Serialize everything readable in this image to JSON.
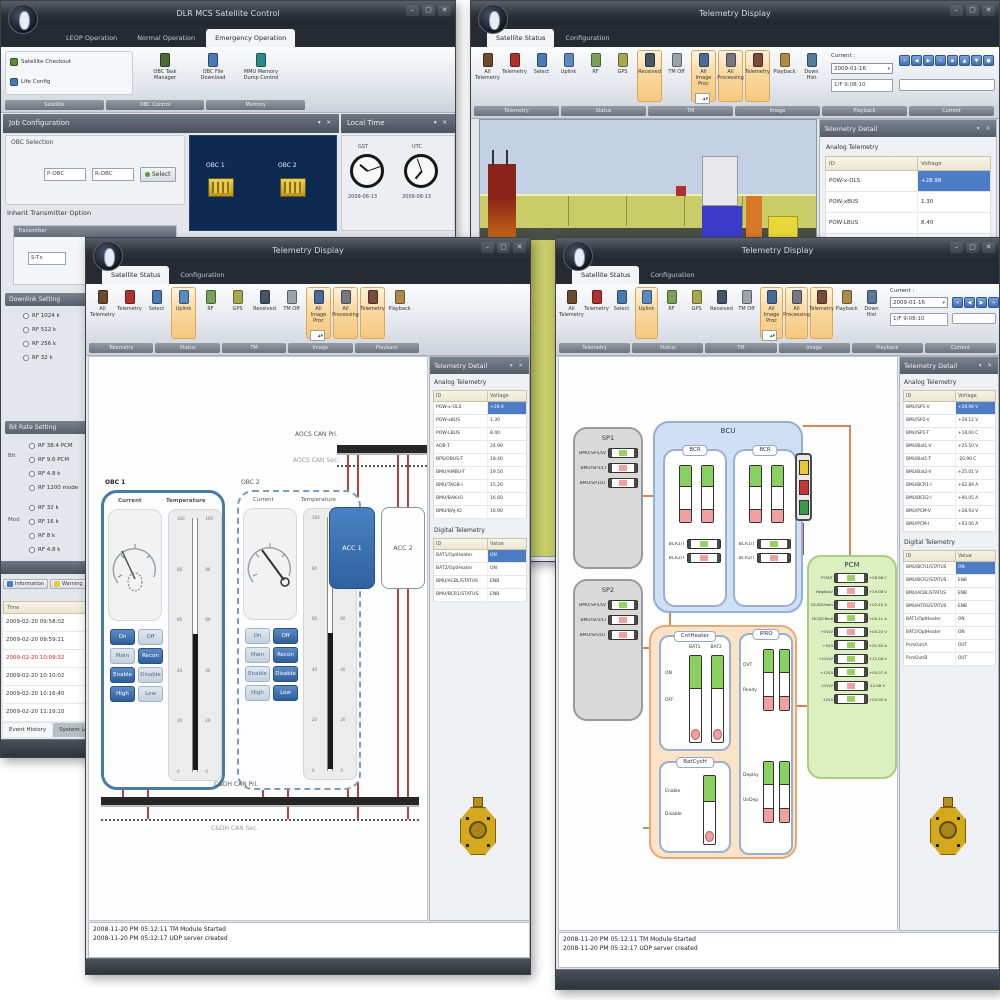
{
  "colors": {
    "selection_blue": "#4d7cc7",
    "ribbon_highlight": "#f5c87e",
    "accent_blue": "#3a72b5",
    "wire_red": "#b84040",
    "wire_orange": "#d88858",
    "navy_panel": "#0e2a52",
    "gold": "#d4a91e",
    "bus_black": "#262626"
  },
  "chrome": {
    "min": "–",
    "max": "▢",
    "close": "✕",
    "panel_icons": "▾ ✕"
  },
  "windowA": {
    "title": "DLR MCS Satellite Control",
    "tabs": [
      {
        "label": "LEOP Operation"
      },
      {
        "label": "Normal Operation"
      },
      {
        "label": "Emergency Operation",
        "active": true
      }
    ],
    "ribbon": {
      "side_buttons": [
        {
          "label": "Satellite Checkout",
          "c": "#5a8a3a"
        },
        {
          "label": "Life Config",
          "c": "#4a7ab5"
        }
      ],
      "big_buttons": [
        {
          "label": "OBC Task Manager",
          "c": "#4a6a3a"
        },
        {
          "label": "OBC File Download",
          "c": "#4a7ab5"
        },
        {
          "label": "MMU Memory Dump Control",
          "c": "#2a8a8a"
        }
      ],
      "groups": [
        "Satellite",
        "OBC Control",
        "Memory"
      ]
    },
    "job_config_header": "Job Configuration",
    "local_time_header": "Local Time",
    "obc_selection": {
      "legend": "OBC Selection",
      "fields": [
        "P-OBC",
        "R-OBC"
      ],
      "select_label": "Select"
    },
    "navy": {
      "items": [
        {
          "label": "OBC 1"
        },
        {
          "label": "OBC 2"
        }
      ]
    },
    "clocks": [
      {
        "caption": "GST",
        "date": "2009-08-13"
      },
      {
        "caption": "UTC",
        "date": "2009-08-13"
      }
    ],
    "transmitter": {
      "legend": "Inherit Transmitter Option",
      "sub_header": "Transmitter",
      "field": "S-Tx"
    },
    "downlink_group": {
      "header": "Downlink Setting",
      "items": [
        "RF 1024 k",
        "RF 512 k",
        "RF 256 k",
        "RF 32 k"
      ]
    },
    "rate_group": {
      "header": "Bit Rate Setting",
      "side1": "Bit",
      "items1": [
        "RF 38.4 PCM",
        "RF 9.6 PCM",
        "RF 4.8 k",
        "RF 1200 mode"
      ],
      "side2": "Mod",
      "items2": [
        "RF 32 k",
        "RF 16 k",
        "RF 8 k",
        "RF 4.8 k"
      ]
    },
    "events": {
      "filters": [
        {
          "label": "Information",
          "c": "#4d7cc7"
        },
        {
          "label": "Warning",
          "c": "#e8c84a"
        },
        {
          "label": "Error",
          "c": "#c0392b"
        }
      ],
      "col": "Time",
      "rows": [
        {
          "t": "2009-02-20 09:58:02"
        },
        {
          "t": "2009-02-20 09:59:11"
        },
        {
          "t": "2009-02-20 10:09:32",
          "err": true
        },
        {
          "t": "2009-02-20 10:10:02"
        },
        {
          "t": "2009-02-20 10:16:40"
        },
        {
          "t": "2009-02-20 11:19:10"
        }
      ],
      "tabs": [
        {
          "label": "Event History",
          "active": true
        },
        {
          "label": "System Log"
        }
      ]
    }
  },
  "windowB": {
    "title": "Telemetry Display",
    "tabs": [
      {
        "label": "Satellite Status",
        "active": true
      },
      {
        "label": "Configuration"
      }
    ],
    "ribbon": {
      "buttons": [
        {
          "label": "All Telemetry",
          "c": "#6b4a2f"
        },
        {
          "label": "Telemetry",
          "c": "#b03030"
        },
        {
          "label": "Select",
          "c": "#4a7ab5"
        },
        {
          "label": "Uplink",
          "c": "#5a8ac0"
        },
        {
          "label": "RF",
          "c": "#7aa05a"
        },
        {
          "label": "GPS",
          "c": "#a8a84a"
        },
        {
          "label": "Received",
          "c": "#445566",
          "hl": true
        },
        {
          "label": "TM Off",
          "c": "#9aa4ae"
        },
        {
          "label": "All Image Proc",
          "c": "#4a6a9a",
          "hl": true
        },
        {
          "label": "All Processing",
          "c": "#777788",
          "hl": true
        },
        {
          "label": "Telemetry",
          "c": "#7a4a3a",
          "hl": true
        },
        {
          "label": "Playback",
          "c": "#b08a4a"
        },
        {
          "label": "Down Hist",
          "c": "#5a7a9a"
        }
      ],
      "groups": [
        "Telemetry",
        "Status",
        "TM",
        "Image",
        "Playback",
        "Current"
      ],
      "spinner": "",
      "current": {
        "label": "Current :",
        "value": "2009-01-16",
        "time": "1/F  9:08:10"
      },
      "nav": [
        "«",
        "◀",
        "▶",
        "»",
        "▪",
        "▲",
        "▼",
        "●"
      ]
    },
    "panel": {
      "header": "Telemetry Detail",
      "analog_title": "Analog Telemetry",
      "cols": [
        "ID",
        "Voltage"
      ],
      "rows": [
        {
          "id": "POW-x-OLS",
          "v": "+28.98",
          "sel": true
        },
        {
          "id": "POW-xBUS",
          "v": "1.30"
        },
        {
          "id": "POW-LBUS",
          "v": "8.40"
        },
        {
          "id": "AOB-T",
          "v": "24.90"
        }
      ]
    }
  },
  "windowC": {
    "title": "Telemetry Display",
    "tabs": [
      {
        "label": "Satellite Status",
        "active": true
      },
      {
        "label": "Configuration"
      }
    ],
    "ribbon": {
      "buttons": [
        {
          "label": "All Telemetry",
          "c": "#6b4a2f"
        },
        {
          "label": "Telemetry",
          "c": "#b03030"
        },
        {
          "label": "Select",
          "c": "#4a7ab5"
        },
        {
          "label": "Uplink",
          "c": "#5a8ac0",
          "hl": true
        },
        {
          "label": "RF",
          "c": "#7aa05a"
        },
        {
          "label": "GPS",
          "c": "#a8a84a"
        },
        {
          "label": "Received",
          "c": "#445566"
        },
        {
          "label": "TM Off",
          "c": "#9aa4ae"
        },
        {
          "label": "All Image Proc",
          "c": "#4a6a9a",
          "hl": true
        },
        {
          "label": "All Processing",
          "c": "#777788",
          "hl": true
        },
        {
          "label": "Telemetry",
          "c": "#7a4a3a",
          "hl": true
        },
        {
          "label": "Playback",
          "c": "#b08a4a"
        }
      ],
      "groups": [
        "Telemetry",
        "Status",
        "TM",
        "Image",
        "Playback"
      ],
      "spinner": ""
    },
    "diagram": {
      "aocs_pri": "AOCS CAN Pri.",
      "aocs_sec": "AOCS CAN Sec.",
      "cdh_pri": "C&DH CAN Pri.",
      "cdh_sec": "C&DH CAN Sec.",
      "acc1": "ACC 1",
      "acc2": "ACC 2",
      "obc1": {
        "title": "OBC 1",
        "gauge_label": "Current",
        "thermo_label": "Temperature",
        "scale": [
          "100",
          "80",
          "60",
          "40",
          "20",
          "0"
        ],
        "buttons": [
          {
            "label": "On",
            "on": true
          },
          {
            "label": "Off"
          },
          {
            "label": "Main"
          },
          {
            "label": "Recon",
            "on": true
          },
          {
            "label": "Enable",
            "on": true
          },
          {
            "label": "Disable"
          },
          {
            "label": "High",
            "on": true
          },
          {
            "label": "Low"
          }
        ]
      },
      "obc2": {
        "title": "OBC 2",
        "gauge_label": "Current",
        "thermo_label": "Temperature",
        "scale": [
          "100",
          "80",
          "60",
          "40",
          "20",
          "0"
        ],
        "buttons": [
          {
            "label": "On"
          },
          {
            "label": "Off",
            "on": true
          },
          {
            "label": "Main"
          },
          {
            "label": "Recon",
            "on": true
          },
          {
            "label": "Enable"
          },
          {
            "label": "Disable",
            "on": true
          },
          {
            "label": "High"
          },
          {
            "label": "Low",
            "on": true
          }
        ]
      }
    },
    "panel": {
      "header": "Telemetry Detail",
      "analog_title": "Analog Telemetry",
      "analog_cols": [
        "ID",
        "Voltage"
      ],
      "analog_rows": [
        {
          "id": "POW-x-OLS",
          "v": "+28.9",
          "sel": true
        },
        {
          "id": "POW-xBUS",
          "v": "1.30"
        },
        {
          "id": "POW-LBUS",
          "v": "8.40"
        },
        {
          "id": "AOB-T",
          "v": "24.90"
        },
        {
          "id": "BPS/OBUS-T",
          "v": "18.40"
        },
        {
          "id": "BMU/AMBU-T",
          "v": "19.50"
        },
        {
          "id": "BMU/TAGB-I",
          "v": "15.20"
        },
        {
          "id": "BMU/BAK-IO",
          "v": "16.60"
        },
        {
          "id": "BMU/BAJ-IO",
          "v": "16.90"
        }
      ],
      "digital_title": "Digital Telemetry",
      "digital_cols": [
        "ID",
        "Value"
      ],
      "digital_rows": [
        {
          "id": "BAT1/OptHeater",
          "v": "ON",
          "sel": true
        },
        {
          "id": "BAT2/OptHeater",
          "v": "ON"
        },
        {
          "id": "BMU/ACBL/STATUS",
          "v": "ENB"
        },
        {
          "id": "BMU/BCR1/STATUS",
          "v": "ENB"
        }
      ]
    },
    "log": {
      "lines": [
        "2008-11-20 PM 05:12:11   TM Module Started",
        "2008-11-20 PM 05:12:17   UDP server created"
      ]
    }
  },
  "windowD": {
    "title": "Telemetry Display",
    "tabs": [
      {
        "label": "Satellite Status",
        "active": true
      },
      {
        "label": "Configuration"
      }
    ],
    "ribbon": {
      "buttons": [
        {
          "label": "All Telemetry",
          "c": "#6b4a2f"
        },
        {
          "label": "Telemetry",
          "c": "#b03030"
        },
        {
          "label": "Select",
          "c": "#4a7ab5"
        },
        {
          "label": "Uplink",
          "c": "#5a8ac0",
          "hl": true
        },
        {
          "label": "RF",
          "c": "#7aa05a"
        },
        {
          "label": "GPS",
          "c": "#a8a84a"
        },
        {
          "label": "Received",
          "c": "#445566"
        },
        {
          "label": "TM Off",
          "c": "#9aa4ae"
        },
        {
          "label": "All Image Proc",
          "c": "#4a6a9a",
          "hl": true
        },
        {
          "label": "All Processing",
          "c": "#777788",
          "hl": true
        },
        {
          "label": "Telemetry",
          "c": "#7a4a3a",
          "hl": true
        },
        {
          "label": "Playback",
          "c": "#b08a4a"
        },
        {
          "label": "Down Hist",
          "c": "#5a7a9a"
        }
      ],
      "groups": [
        "Telemetry",
        "Status",
        "TM",
        "Image",
        "Playback",
        "Current"
      ],
      "spinner": "",
      "current": {
        "label": "Current :",
        "value": "2009-01-16",
        "time": "1/F  9:08:10"
      },
      "nav": [
        "«",
        "◀",
        "▶",
        "»"
      ]
    },
    "diagram": {
      "sp1": {
        "title": "SP1",
        "rows": [
          {
            "label": "BMU/SP1/LV",
            "g": true
          },
          {
            "label": "BMU/SP1/LI"
          },
          {
            "label": "BMU/SP1/LT"
          }
        ]
      },
      "sp2": {
        "title": "SP2",
        "rows": [
          {
            "label": "BMU/SP2/LV",
            "g": true
          },
          {
            "label": "BMU/SP2/LI"
          },
          {
            "label": "BMU/SP2/LT"
          }
        ]
      },
      "bcu": {
        "title": "BCU",
        "bcr1": {
          "title": "BCR",
          "rows": [
            {
              "label": "BCR1/T",
              "g": true
            },
            {
              "label": "BCR2/T"
            }
          ]
        },
        "bcr2": {
          "title": "BCR",
          "rows": [
            {
              "label": "BCR1/T",
              "g": true
            },
            {
              "label": "BCR2/T"
            }
          ]
        }
      },
      "cntheater": {
        "title": "CntHeater",
        "cols": [
          "BAT1",
          "BAT2"
        ],
        "rows": [
          "ON",
          "OFF"
        ]
      },
      "batcych": {
        "title": "BatCycH",
        "rows": [
          "Enable",
          "Disable"
        ]
      },
      "ipro": {
        "title": "IPRO",
        "upper": [
          "OVT",
          "Ready"
        ],
        "lower": [
          "Deploy",
          "UnDep"
        ]
      },
      "pcm": {
        "title": "PCM",
        "rows": [
          {
            "label": "PCM/T",
            "v": "+28.98 C",
            "g": true
          },
          {
            "label": "RegBusV",
            "v": "+29.08 V"
          },
          {
            "label": "DC/DCMainI",
            "v": "+02.45 A"
          },
          {
            "label": "DC/DCRedI",
            "v": "+05.11 A",
            "g": true
          },
          {
            "label": "+5V/V",
            "v": "+05.20 V"
          },
          {
            "label": "+5V/I",
            "v": "+01.50 A",
            "g": true
          },
          {
            "label": "+12V/V",
            "v": "+12.08 V",
            "g": true
          },
          {
            "label": "+12V/I",
            "v": "+00.07 A",
            "g": true
          },
          {
            "label": "-12V/V",
            "v": "-12.08 V"
          },
          {
            "label": "-12V/I",
            "v": "+00.05 A",
            "g": true
          }
        ]
      }
    },
    "panel": {
      "header": "Telemetry Detail",
      "analog_title": "Analog Telemetry",
      "analog_cols": [
        "ID",
        "Voltage"
      ],
      "analog_rows": [
        {
          "id": "BMU/SP1-V",
          "v": "+28.98 V",
          "sel": true
        },
        {
          "id": "BMU/SP2-V",
          "v": "+28.12 V"
        },
        {
          "id": "BMU/SP1-T",
          "v": "+18.00 C"
        },
        {
          "id": "BMU/Bat1-V",
          "v": "+25.50 V"
        },
        {
          "id": "BMU/Bat1-T",
          "v": "-20.90 C"
        },
        {
          "id": "BMU/Bat2-V",
          "v": "+25.01 V"
        },
        {
          "id": "BMU/BCR1-I",
          "v": "+02.89 A"
        },
        {
          "id": "BMU/BCR2-I",
          "v": "+00.05 A"
        },
        {
          "id": "BMU/PCM-V",
          "v": "+28.93 V"
        },
        {
          "id": "BMU/PCM-I",
          "v": "+03.00 A"
        }
      ],
      "digital_title": "Digital Telemetry",
      "digital_cols": [
        "ID",
        "Value"
      ],
      "digital_rows": [
        {
          "id": "BMU/BCR1/STATUS",
          "v": "ON",
          "sel": true
        },
        {
          "id": "BMU/BCR2/STATUS",
          "v": "ENB"
        },
        {
          "id": "BMU/ACBL/STATUS",
          "v": "ENB"
        },
        {
          "id": "BMU/HTRS/STATUS",
          "v": "ENB"
        },
        {
          "id": "BAT1/OptHeater",
          "v": "ON"
        },
        {
          "id": "BAT2/OptHeater",
          "v": "ON"
        },
        {
          "id": "PcmOut/A",
          "v": "OUT"
        },
        {
          "id": "PcmOut/B",
          "v": "OUT"
        }
      ]
    },
    "log": {
      "lines": [
        "2008-11-20 PM 05:12:11   TM Module Started",
        "2008-11-20 PM 05:12:17   UDP server created"
      ]
    }
  }
}
